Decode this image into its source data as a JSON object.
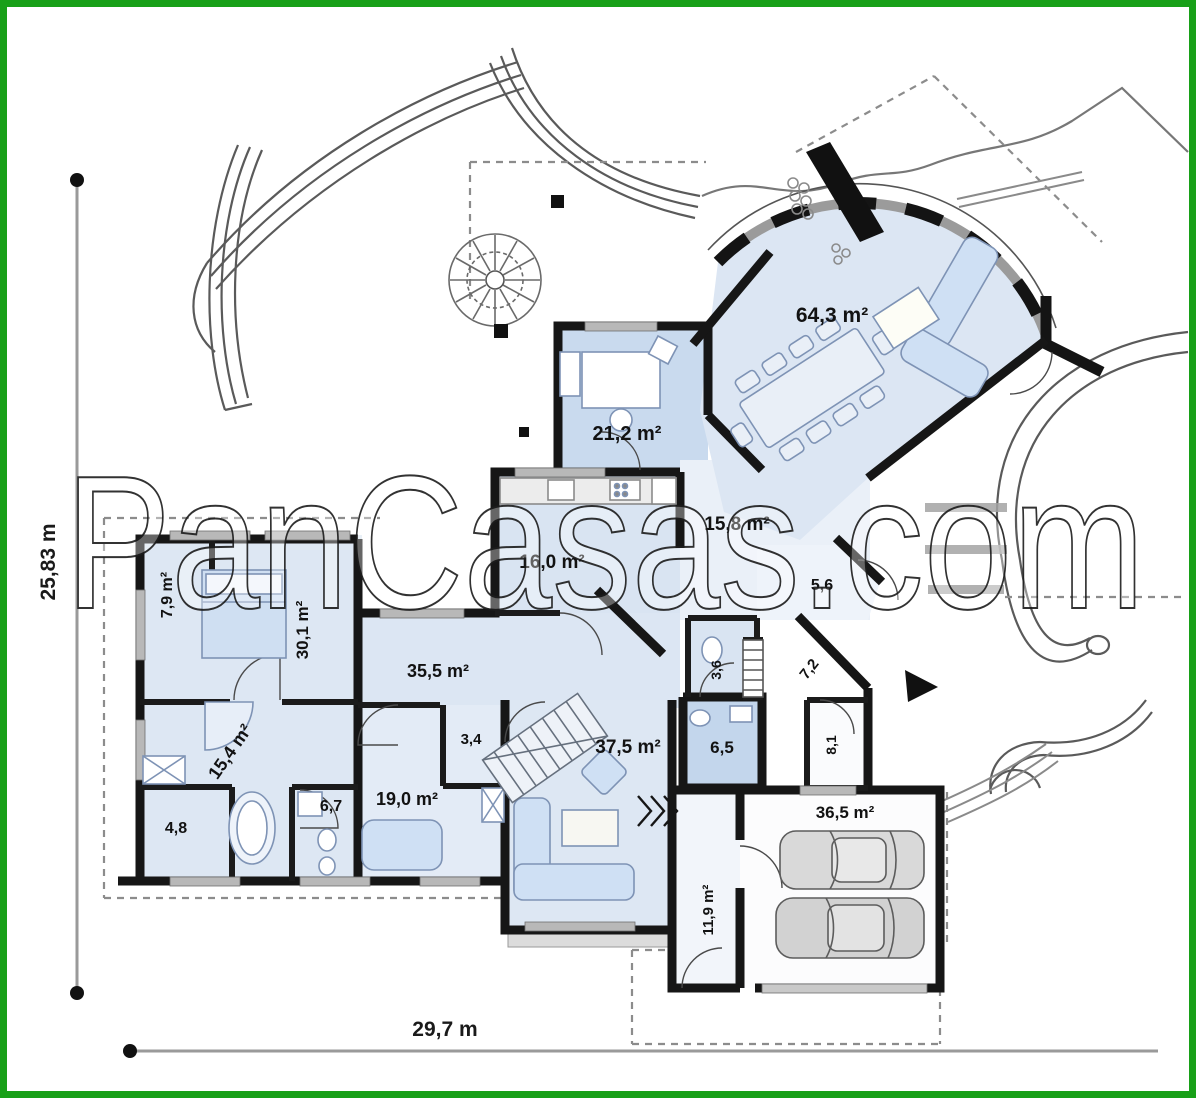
{
  "title": "house floor plan",
  "watermark": {
    "text": "PanCasas.com"
  },
  "dimensions": {
    "height_label": "25,83 m",
    "width_label": "29,7 m"
  },
  "rooms": {
    "living_dining": "64,3 m²",
    "office": "21,2 m²",
    "hall": "15,8 m²",
    "kitchen": "16,0 m²",
    "vestibule": "5,6",
    "dressing": "7,9 m²",
    "bedroom_main": "30,1 m²",
    "corridor": "35,5 m²",
    "bathroom_main": "15,4 m²",
    "storage": "4,8",
    "bathroom_small": "6,7",
    "bedroom_second": "19,0 m²",
    "wardrobe": "3,4",
    "family_room": "37,5 m²",
    "bathroom_guest": "6,5",
    "wc": "3,6",
    "hallway": "7,2",
    "pantry": "8,1",
    "garage": "36,5 m²",
    "boiler_room": "11,9 m²"
  },
  "colors": {
    "border_green": "#18a018",
    "room_fill": "#dde7f3",
    "highlight_fill": "#c3d6ec",
    "wall": "#161616",
    "window_gray": "#b8b8b8"
  }
}
